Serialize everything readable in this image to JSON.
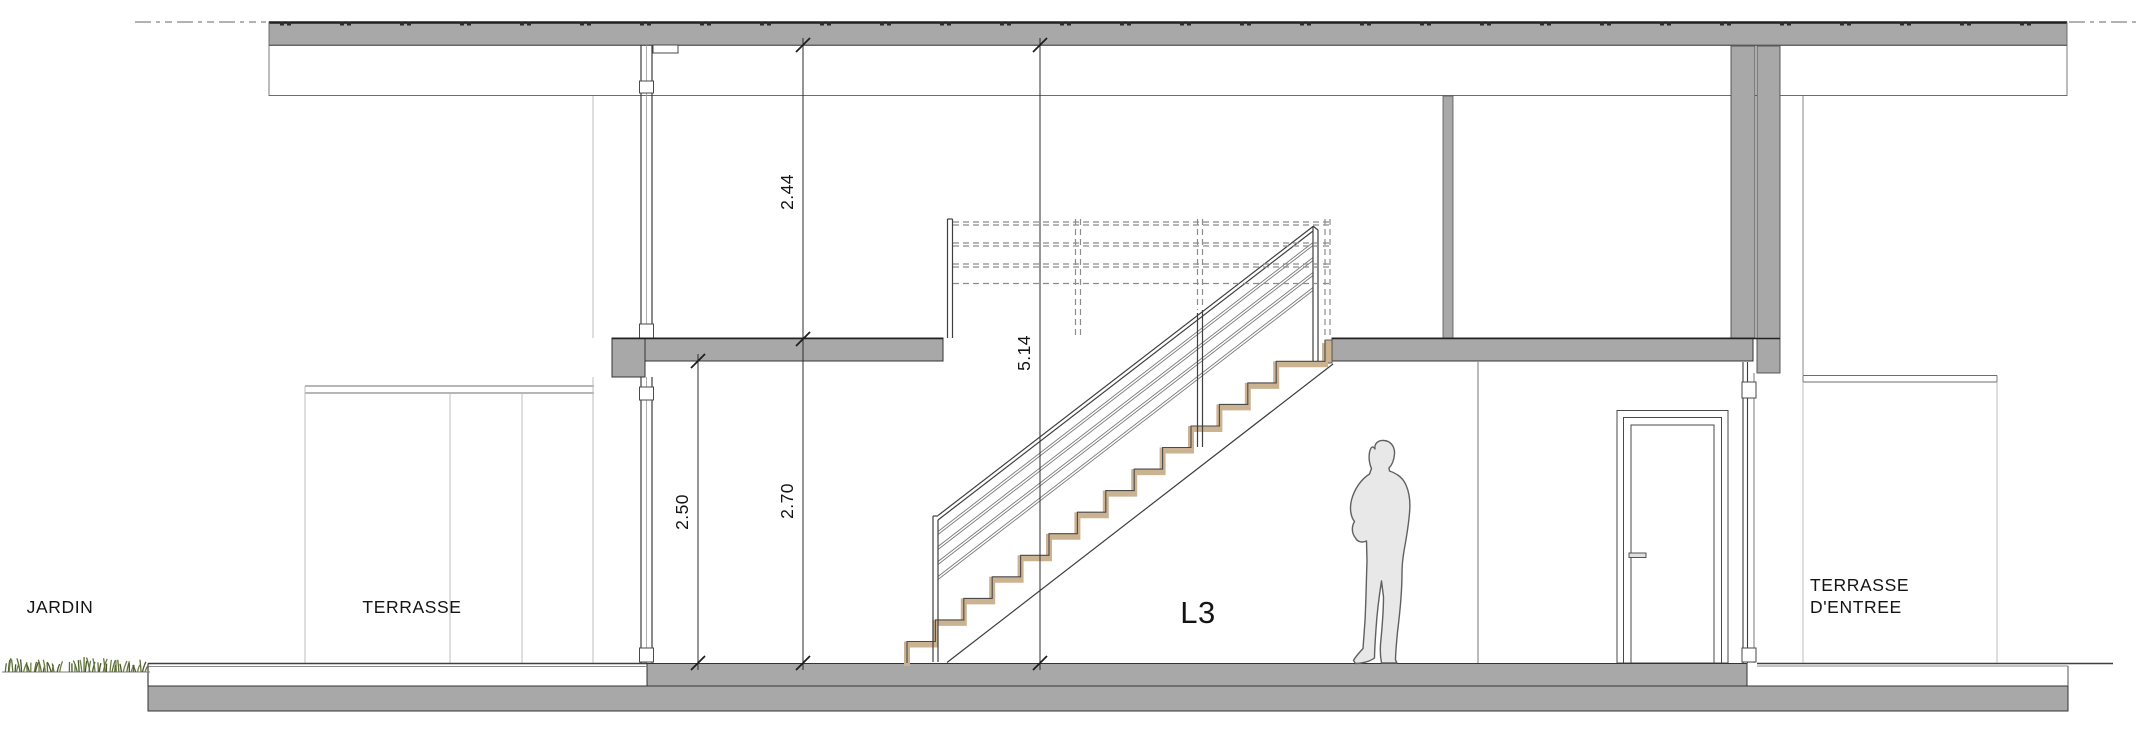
{
  "drawing": {
    "title": "Coupe - section drawing",
    "labels": {
      "jardin": "JARDIN",
      "terrasse": "TERRASSE",
      "level": "L3",
      "entry_line1": "TERRASSE",
      "entry_line2": "D'ENTREE"
    },
    "dimensions": {
      "upper_clear_height": "2.44",
      "total_height": "5.14",
      "lower_clear_height": "2.50",
      "floor_to_floor": "2.70"
    },
    "colors": {
      "cut_gray": "#a8a8a8",
      "stair_tan": "#cbb291",
      "grass_green": "#5d7036",
      "grass_dark": "#49582c",
      "person_gray": "#e8e8e8",
      "line_dark": "#2d2d2d"
    }
  }
}
